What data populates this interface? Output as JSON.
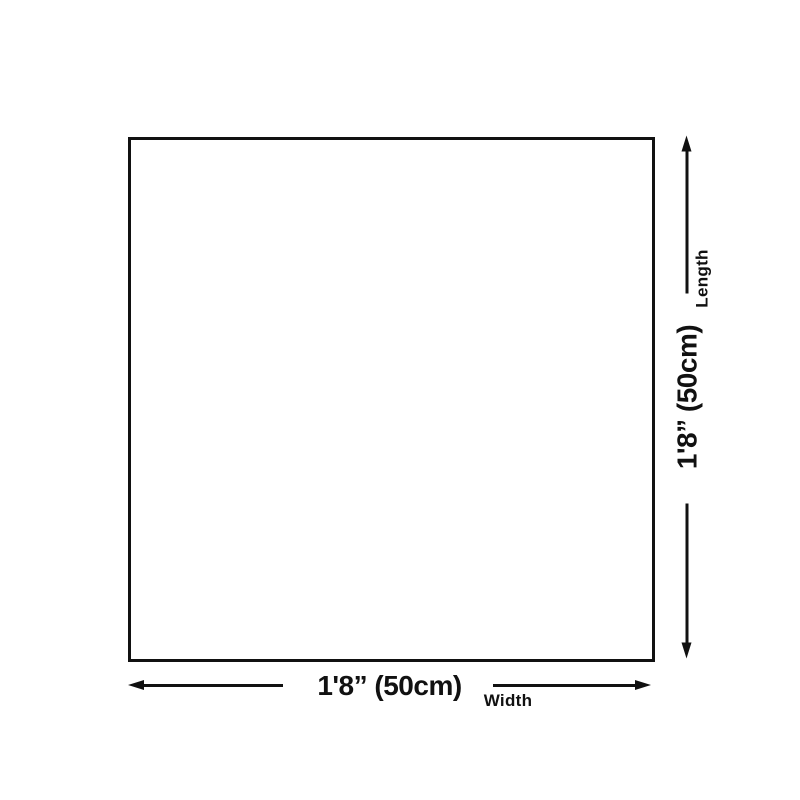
{
  "colors": {
    "ink": "#111111",
    "background": "#ffffff"
  },
  "diagram": {
    "shape": "square-outline",
    "dimensions": {
      "width": {
        "value": "1'8” (50cm)",
        "label": "Width"
      },
      "length": {
        "value": "1'8” (50cm)",
        "label": "Length"
      }
    }
  }
}
